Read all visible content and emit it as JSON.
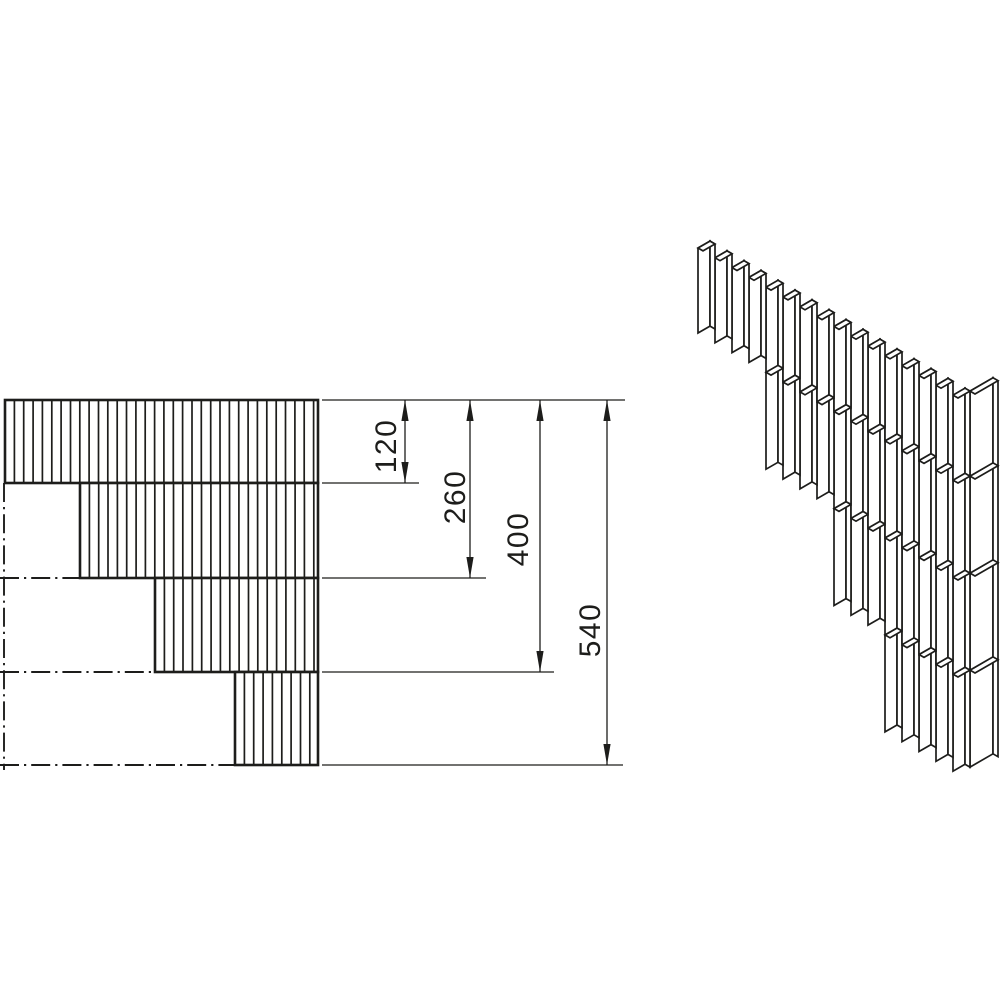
{
  "diagram": {
    "title": "Stepped wall corner - toothing detail, plan and isometric view",
    "colors": {
      "line": "#1d1d1b",
      "background": "#ffffff"
    },
    "dimensions": {
      "unit_values": [
        120,
        260,
        400,
        540
      ],
      "labels": [
        "120",
        "260",
        "400",
        "540"
      ]
    },
    "plan_view": {
      "hatch_spacing": 9.35,
      "courses": [
        {
          "x": 5,
          "y": 400,
          "w": 313,
          "h": 83
        },
        {
          "x": 80,
          "y": 483,
          "w": 238,
          "h": 95
        },
        {
          "x": 155,
          "y": 578,
          "w": 163,
          "h": 94
        },
        {
          "x": 235,
          "y": 672,
          "w": 83,
          "h": 93
        }
      ],
      "centerlines": [
        {
          "x1": 4,
          "y1": 483,
          "x2": 4,
          "y2": 770
        },
        {
          "x1": 0,
          "y1": 578,
          "x2": 155,
          "y2": 578
        },
        {
          "x1": 0,
          "y1": 672,
          "x2": 235,
          "y2": 672
        },
        {
          "x1": 0,
          "y1": 765,
          "x2": 235,
          "y2": 765
        }
      ],
      "extension_lines": [
        {
          "y": 400,
          "x1": 322,
          "x2": 625
        },
        {
          "y": 483,
          "x1": 322,
          "x2": 419
        },
        {
          "y": 578,
          "x1": 322,
          "x2": 486
        },
        {
          "y": 672,
          "x1": 322,
          "x2": 554
        },
        {
          "y": 765,
          "x1": 322,
          "x2": 623
        }
      ],
      "dimension_lines": [
        {
          "x": 405,
          "y1": 400,
          "y2": 483,
          "label": "120"
        },
        {
          "x": 470,
          "y1": 400,
          "y2": 578,
          "label": "260"
        },
        {
          "x": 540,
          "y1": 400,
          "y2": 672,
          "label": "400"
        },
        {
          "x": 607,
          "y1": 400,
          "y2": 765,
          "label": "540"
        }
      ],
      "arrow": {
        "length": 21,
        "half_width": 3.6
      }
    },
    "iso_view": {
      "origin": [
        698,
        248
      ],
      "pitch": [
        17,
        9.81
      ],
      "wide_step": [
        12,
        -6.93
      ],
      "thin_step": [
        5,
        2.89
      ],
      "end_step": [
        23,
        -13.28
      ],
      "courses": [
        {
          "start": 0,
          "count": 16,
          "height": 85
        },
        {
          "start": 4,
          "count": 12,
          "height": 97
        },
        {
          "start": 8,
          "count": 8,
          "height": 97
        },
        {
          "start": 11,
          "count": 5,
          "height": 97
        }
      ]
    }
  }
}
